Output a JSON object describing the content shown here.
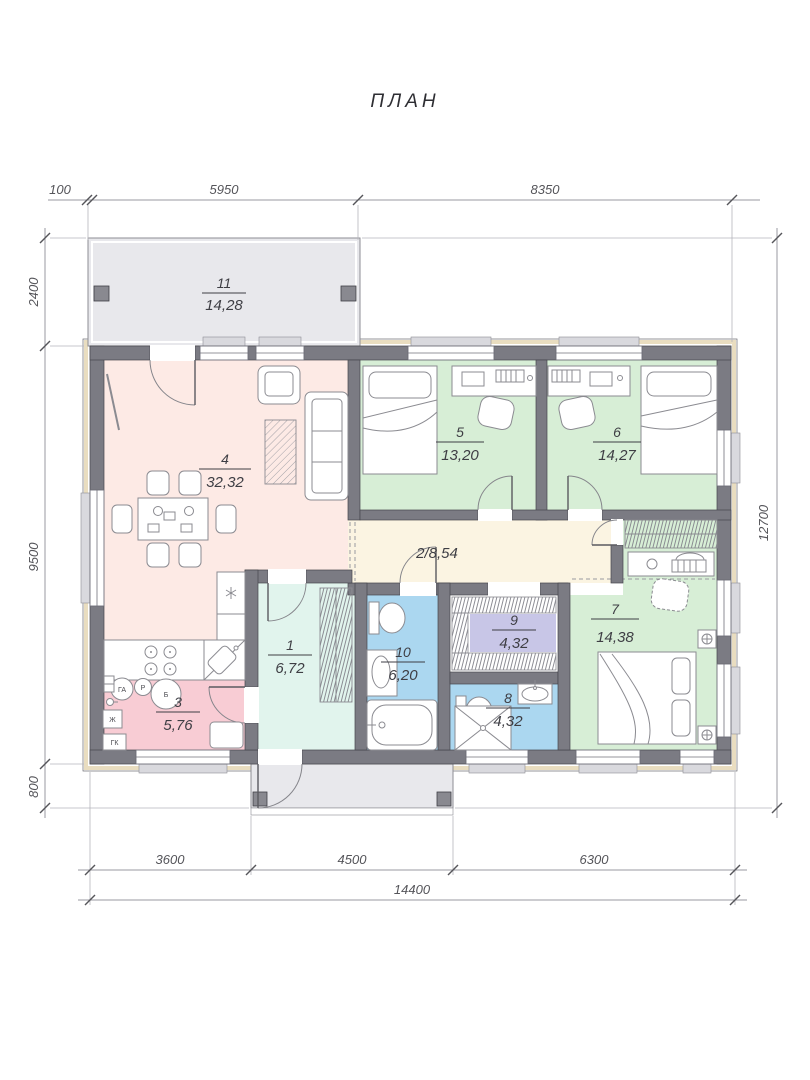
{
  "title": "ПЛАН",
  "dimensions": {
    "top": [
      "100",
      "5950",
      "8350"
    ],
    "left": [
      "2400",
      "9500",
      "800"
    ],
    "right": [
      "12700"
    ],
    "bottom": [
      "3600",
      "4500",
      "6300"
    ],
    "bottom_total": "14400"
  },
  "rooms": {
    "r1": {
      "num": "1",
      "area": "6,72"
    },
    "r2": {
      "label": "2/8,54"
    },
    "r3": {
      "num": "3",
      "area": "5,76"
    },
    "r4": {
      "num": "4",
      "area": "32,32"
    },
    "r5": {
      "num": "5",
      "area": "13,20"
    },
    "r6": {
      "num": "6",
      "area": "14,27"
    },
    "r7": {
      "num": "7",
      "area": "14,38"
    },
    "r8": {
      "num": "8",
      "area": "4,32"
    },
    "r9": {
      "num": "9",
      "area": "4,32"
    },
    "r10": {
      "num": "10",
      "area": "6,20"
    },
    "r11": {
      "num": "11",
      "area": "14,28"
    }
  },
  "appliances": {
    "ga": "ГА",
    "r": "Р",
    "b": "Б",
    "zh": "Ж",
    "gk": "ГК"
  },
  "colors": {
    "terrace": "#e8e8ec",
    "wall": "#7b7b83",
    "trim": "#e9ddc0",
    "living": "#fdeae5",
    "utility": "#f8ccd4",
    "bedroom": "#d7eed6",
    "hall": "#fbf4e2",
    "entry": "#e1f4ed",
    "bath": "#abd7f0",
    "wardrobe": "#c8c6e7"
  }
}
